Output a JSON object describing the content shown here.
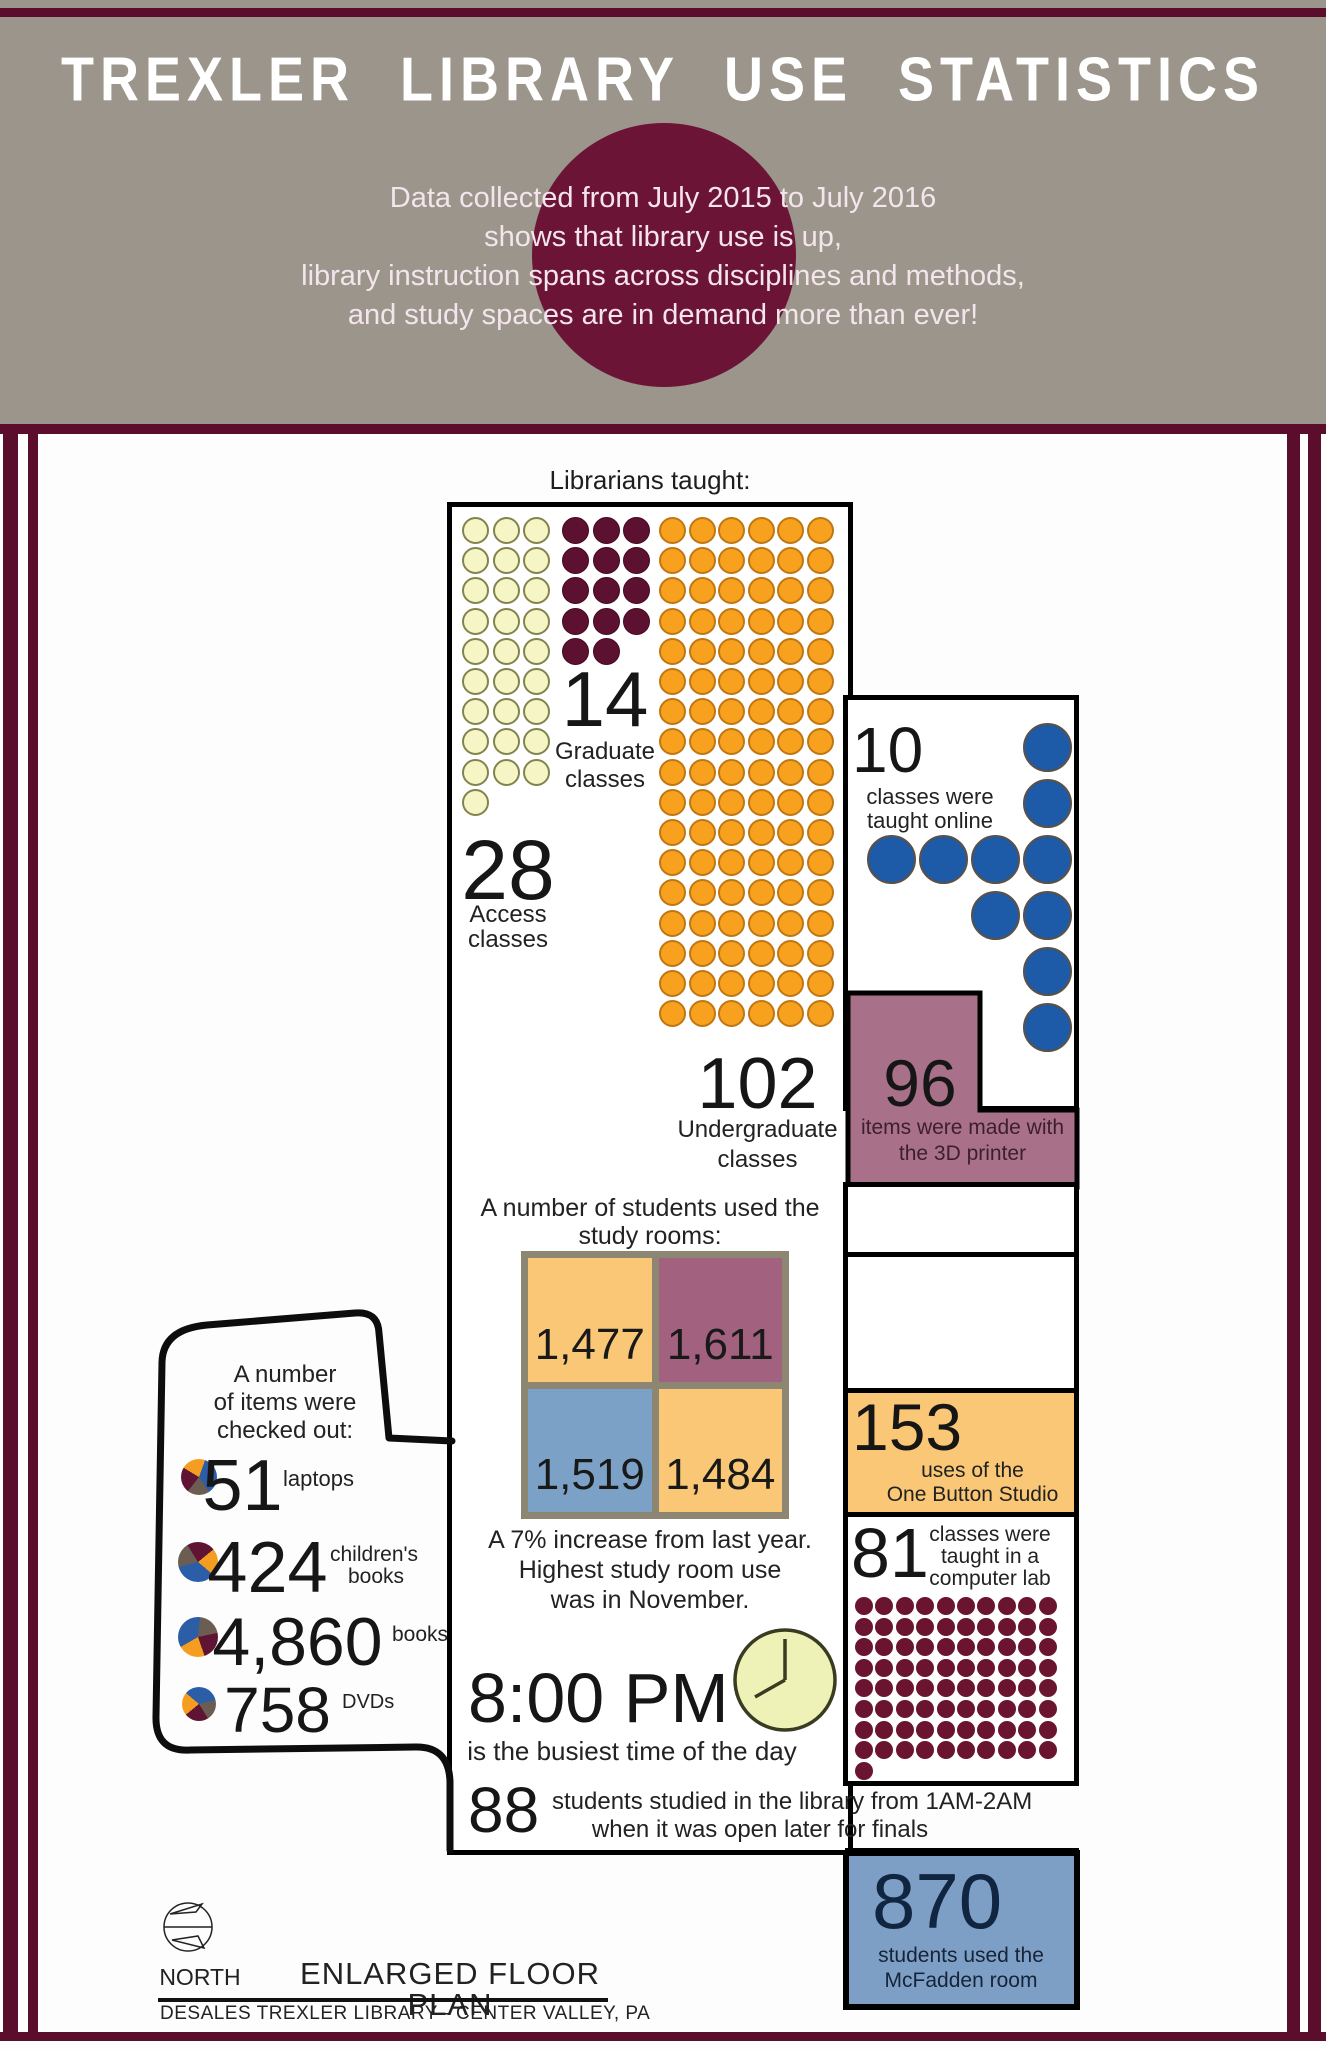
{
  "header": {
    "title": "TREXLER LIBRARY USE STATISTICS",
    "subtitle_lines": [
      "Data collected from July 2015 to July 2016",
      "shows that library use is up,",
      "library instruction spans across disciplines and methods,",
      "and study spaces are in demand more than ever!"
    ]
  },
  "librarians": {
    "heading": "Librarians taught:",
    "graduate": {
      "value": "14",
      "count": 14,
      "line1": "Graduate",
      "line2": "classes"
    },
    "access": {
      "value": "28",
      "count": 28,
      "line1": "Access",
      "line2": "classes"
    },
    "undergraduate": {
      "value": "102",
      "count": 102,
      "line1": "Undergraduate",
      "line2": "classes"
    },
    "online": {
      "value": "10",
      "count": 10,
      "line1": "classes were",
      "line2": "taught online"
    }
  },
  "printer": {
    "value": "96",
    "line1": "items were made with",
    "line2": "the 3D printer"
  },
  "study_rooms": {
    "heading1": "A number of students used the",
    "heading2": "study rooms:",
    "cells": [
      {
        "value": "1,477"
      },
      {
        "value": "1,611"
      },
      {
        "value": "1,519"
      },
      {
        "value": "1,484"
      }
    ],
    "note1": "A 7% increase from last year.",
    "note2": "Highest study room use",
    "note3": "was in November."
  },
  "checkouts": {
    "heading1": "A number",
    "heading2": "of items were",
    "heading3": "checked out:",
    "items": [
      {
        "value": "51",
        "label1": "laptops"
      },
      {
        "value": "424",
        "label1": "children's",
        "label2": "books"
      },
      {
        "value": "4,860",
        "label1": "books"
      },
      {
        "value": "758",
        "label1": "DVDs"
      }
    ]
  },
  "one_button": {
    "value": "153",
    "line1": "uses of the",
    "line2": "One Button Studio"
  },
  "computer_lab": {
    "value": "81",
    "count": 81,
    "line1": "classes were",
    "line2": "taught in a",
    "line3": "computer lab"
  },
  "busiest": {
    "time": "8:00 PM",
    "caption": "is the busiest time of the day"
  },
  "late_finals": {
    "value": "88",
    "line1": "students studied in the library from 1AM-2AM",
    "line2": "when it was open later for finals"
  },
  "mcfadden": {
    "value": "870",
    "line1": "students used the",
    "line2": "McFadden room"
  },
  "footer": {
    "north": "NORTH",
    "plan_title": "ENLARGED FLOOR PLAN",
    "plan_subtitle": "DESALES TREXLER LIBRARY - CENTER VALLEY, PA"
  },
  "colors": {
    "maroon": "#5b0e2c",
    "circle_maroon": "#6b1436",
    "header_gray": "#9b958b",
    "amber": "#f9c775",
    "mauve": "#a87189",
    "mauve_cell": "#a2617e",
    "blue_box": "#7e9fc5",
    "blue_cell": "#7ba1c7",
    "blue_dot": "#1d5aa8",
    "orange_dot": "#f7a11f",
    "yellow_dot": "#f5f5c6",
    "dark_dot": "#5d1130",
    "clock_face": "#eef2b6"
  },
  "chart_data": [
    {
      "type": "bar",
      "title": "Librarians taught",
      "categories": [
        "Graduate classes",
        "Access classes",
        "Undergraduate classes",
        "Classes taught online"
      ],
      "values": [
        14,
        28,
        102,
        10
      ],
      "note": "pictogram (dot) chart"
    },
    {
      "type": "table",
      "title": "A number of students used the study rooms",
      "categories": [
        "room 1",
        "room 2",
        "room 3",
        "room 4"
      ],
      "values": [
        1477,
        1611,
        1519,
        1484
      ],
      "note": "A 7% increase from last year. Highest study room use was in November."
    },
    {
      "type": "bar",
      "title": "A number of items were checked out",
      "categories": [
        "laptops",
        "children's books",
        "books",
        "DVDs"
      ],
      "values": [
        51,
        424,
        4860,
        758
      ]
    },
    {
      "type": "bar",
      "title": "Other library statistics",
      "categories": [
        "items made with the 3D printer",
        "uses of the One Button Studio",
        "classes taught in a computer lab",
        "students in library 1AM-2AM during finals",
        "students used the McFadden room"
      ],
      "values": [
        96,
        153,
        81,
        88,
        870
      ]
    }
  ]
}
